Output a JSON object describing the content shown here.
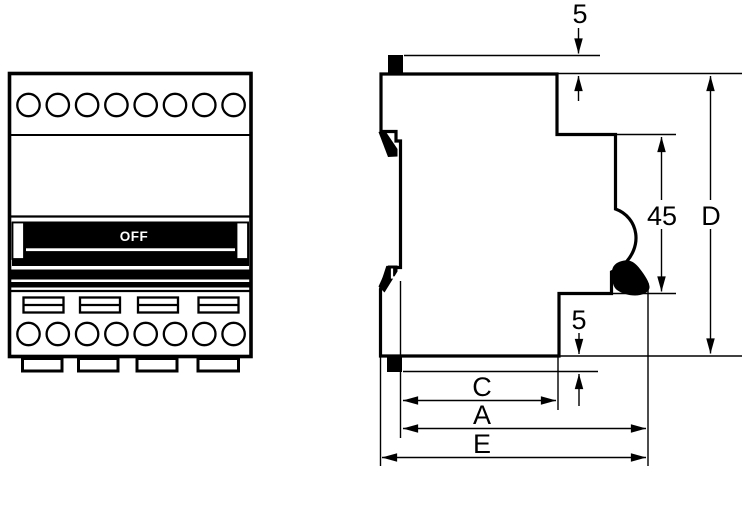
{
  "drawing": {
    "title_hint": "circuit-breaker dimension drawing",
    "front_view": {
      "switch_label": "OFF",
      "top_terminal_count": 8,
      "bottom_terminal_count": 8,
      "slot_count": 4,
      "foot_count": 4
    },
    "side_view": {
      "dim_top_protrusion": "5",
      "dim_bottom_protrusion": "5",
      "dim_front_height": "45",
      "dim_depth": "D",
      "dim_width_c": "C",
      "dim_width_a": "A",
      "dim_width_e": "E"
    },
    "colors": {
      "ink": "#000000",
      "paper": "#ffffff"
    }
  }
}
